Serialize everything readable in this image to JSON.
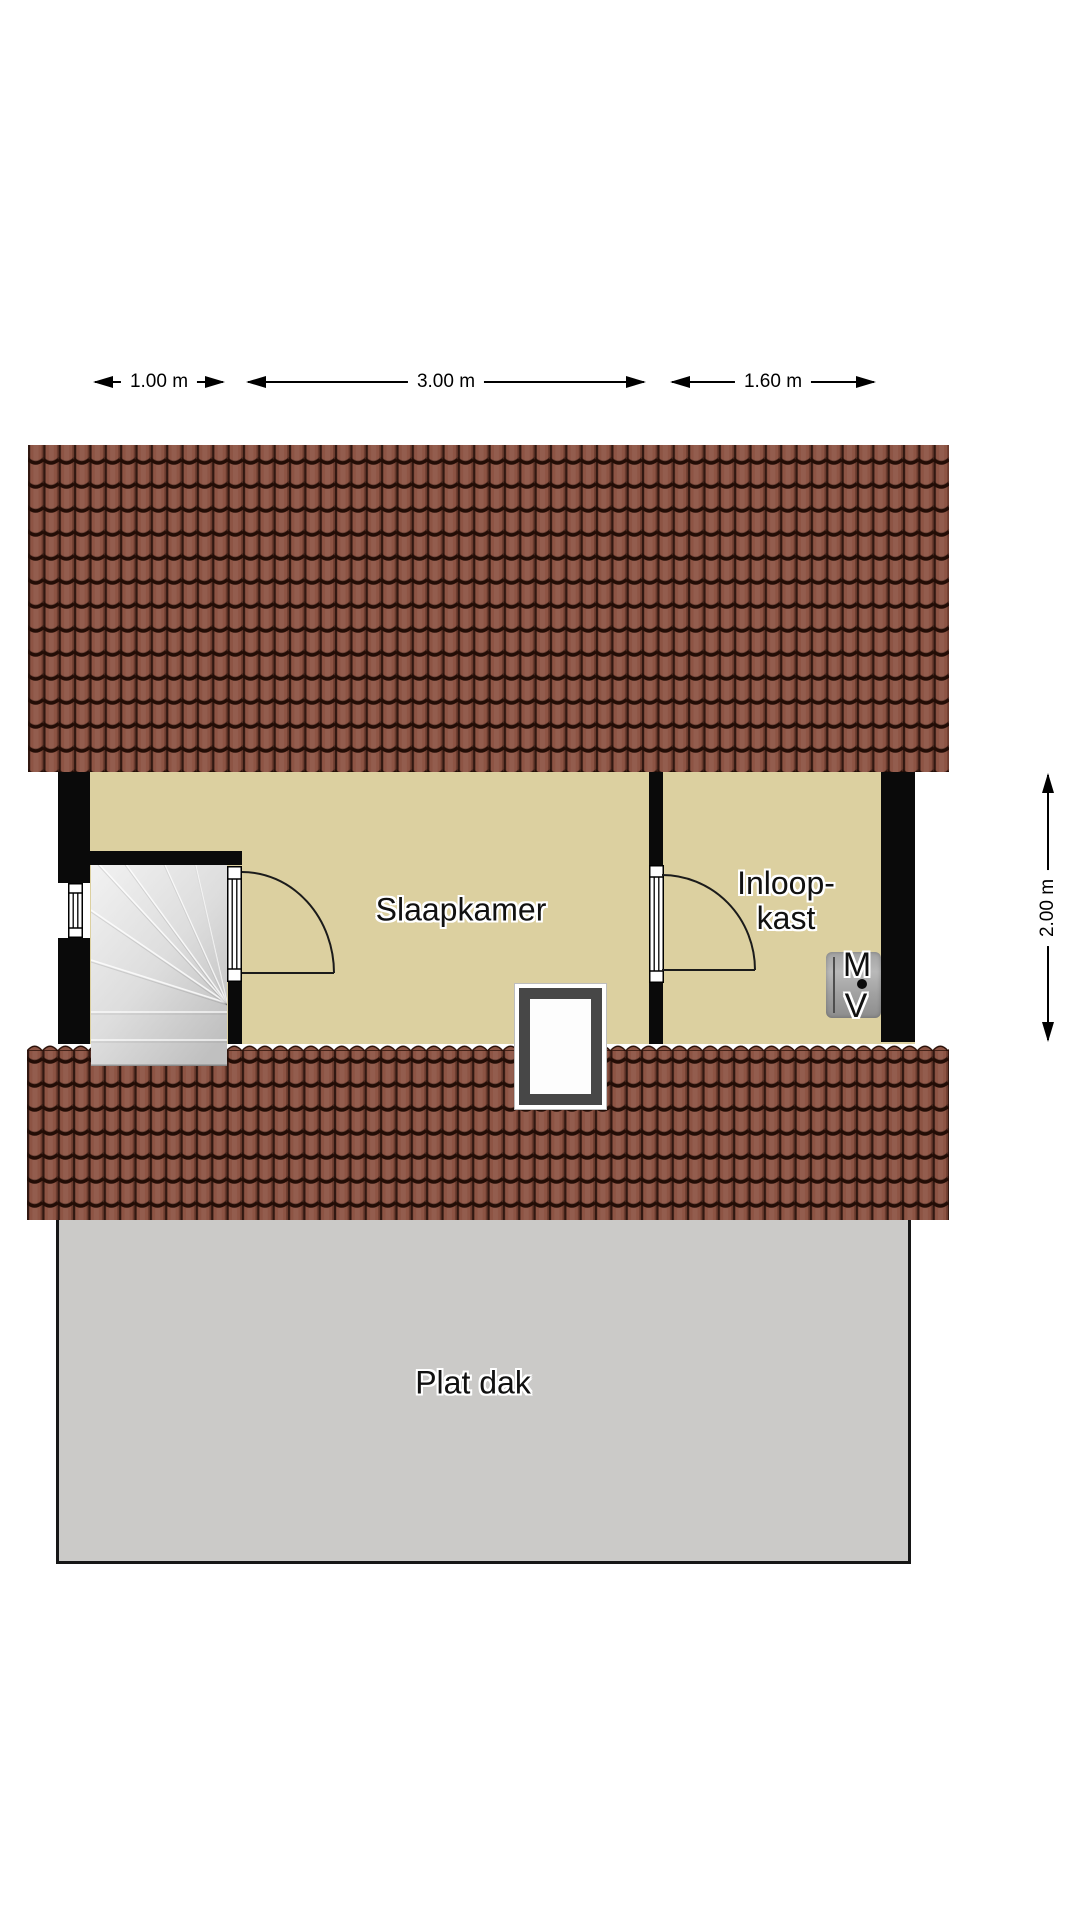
{
  "dimensions": {
    "top": [
      {
        "label": "1.00 m"
      },
      {
        "label": "3.00 m"
      },
      {
        "label": "1.60 m"
      }
    ],
    "right": {
      "label": "2.00 m"
    }
  },
  "rooms": {
    "bedroom": "Slaapkamer",
    "closet_line1": "Inloop-",
    "closet_line2": "kast",
    "flat_roof": "Plat dak"
  },
  "mv_unit": {
    "letter_top": "M",
    "letter_bottom": "V"
  },
  "colors": {
    "roof_tile": "#8d5444",
    "roof_joint_line": "#2a1109",
    "floor": "#dcd0a0",
    "wall": "#0a0a0a",
    "flat_roof": "#cbcac8",
    "stairs": "#d9d9d9",
    "mv_box": "#a9a9a9",
    "skylight_frame": "#474747"
  }
}
